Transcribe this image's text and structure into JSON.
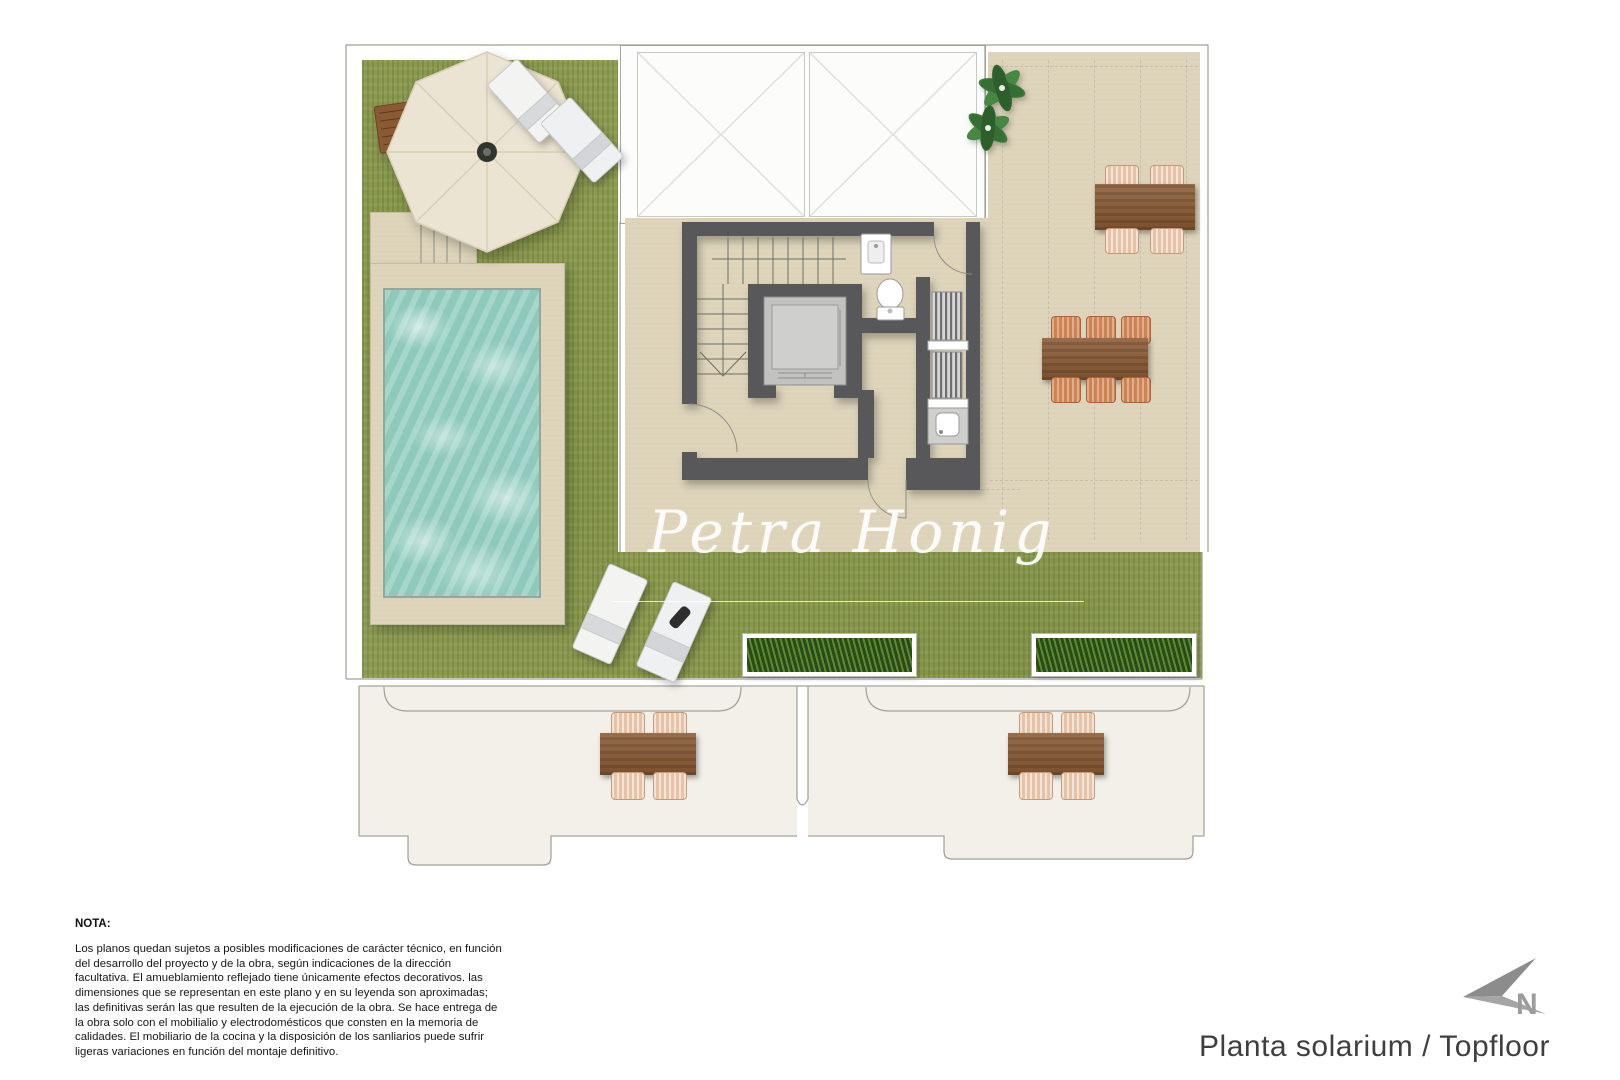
{
  "plan": {
    "title": "Planta solarium / Topfloor"
  },
  "compass": {
    "label": "N"
  },
  "watermark": {
    "text": "Petra Honig"
  },
  "note": {
    "label": "NOTA:",
    "body": "Los planos quedan sujetos a posibles modificaciones de carácter técnico, en función del desarrollo del proyecto y de la obra, según indicaciones de la dirección facultativa. El amueblamiento reflejado tiene únicamente efectos decorativos. las dimensiones que se representan en este plano y en su leyenda son aproximadas; las definitivas serán las que resulten de la ejecución de la obra. Se hace entrega de la obra solo con el mobilialio y electrodomésticos que consten en la memoria de calidades. El mobiliario de la cocina y la disposición de los sanliarios puede sufrir ligeras variaciones en función del montaje definitivo."
  },
  "colors": {
    "grass": "#8e9c53",
    "terrace": "#dcd3b9",
    "water": "#96d0c3",
    "wall": "#58585a",
    "wood": "#8a5a33",
    "wicker": "#e6c3a6",
    "planter": "#2d481a",
    "outline": "#a09f94",
    "north": "#9c9c9c"
  }
}
